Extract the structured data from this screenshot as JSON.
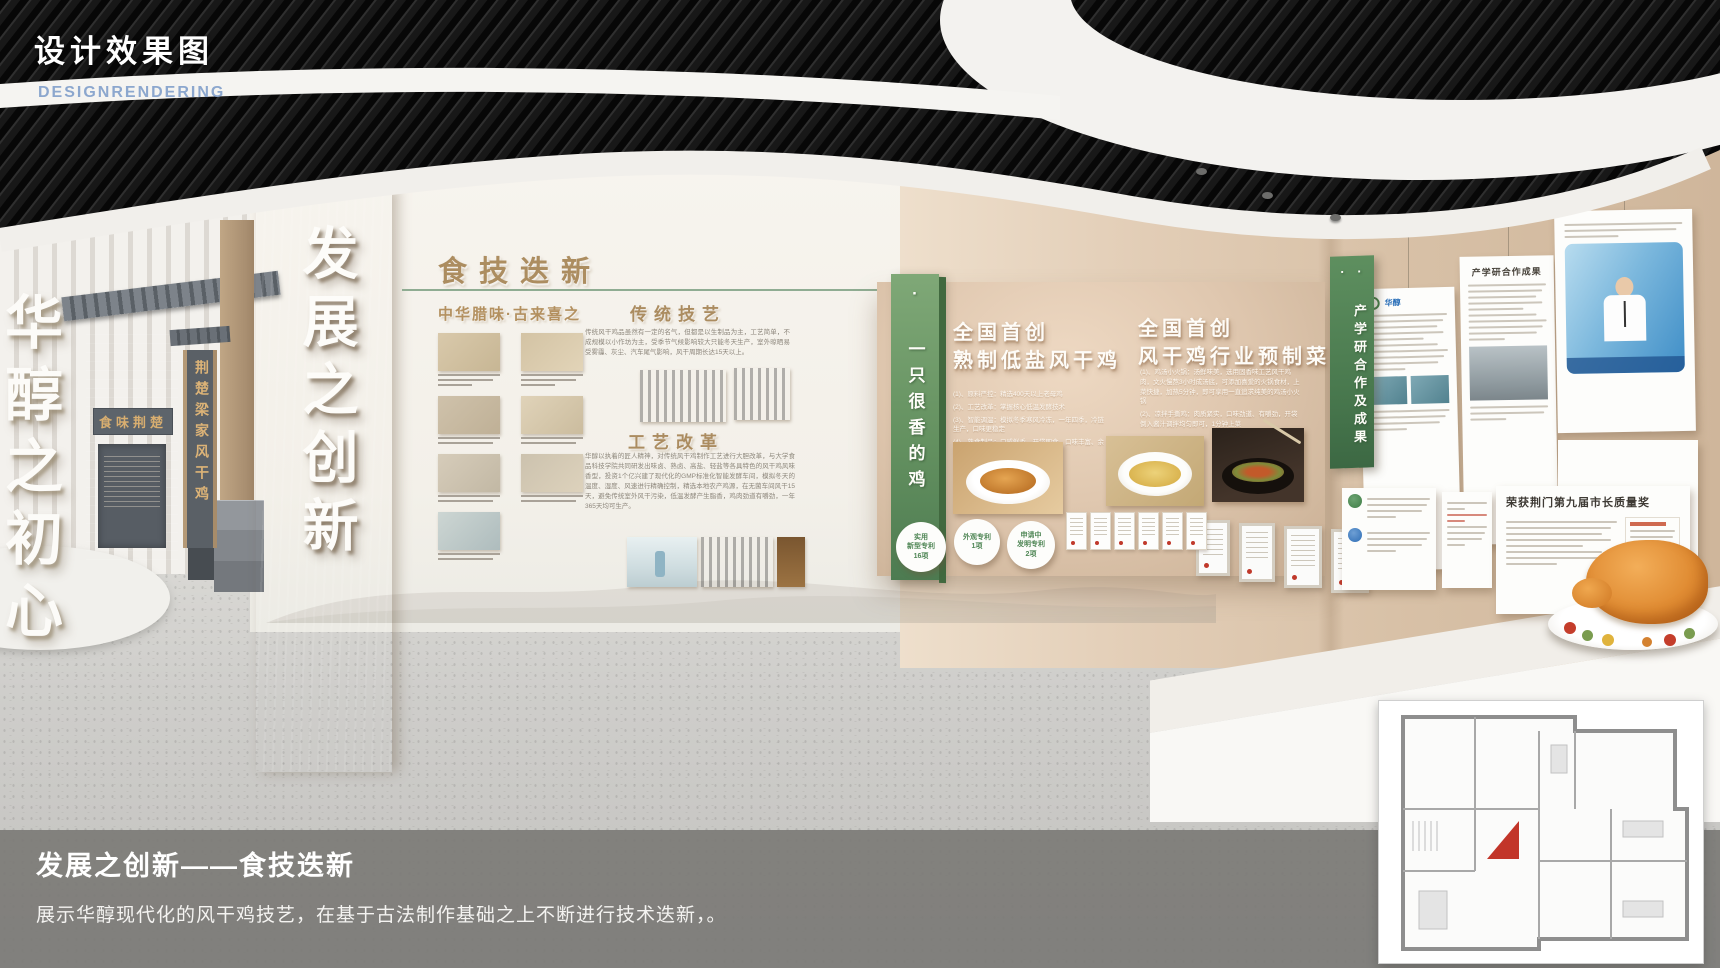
{
  "header": {
    "title": "设计效果图",
    "subtitle": "DESIGNRENDERING"
  },
  "left_wing": {
    "slogan_vertical": "华醇之初心",
    "plaque": "食味荆楚",
    "shop_sign": "荆楚梁家风干鸡"
  },
  "pillar": {
    "text": "发展之创新"
  },
  "tech_wall": {
    "title": "食技迭新",
    "section1": {
      "heading": "中华腊味·古来喜之"
    },
    "section2": {
      "heading": "传统技艺",
      "body": "传统风干鸡品虽然有一定的名气，但都是以生制品为主，工艺简单，不成规模以小作坊为主，受季节气候影响较大只能冬天生产，室外晾晒易受雾霾、灰尘、汽车尾气影响，风干周期长达15天以上。"
    },
    "section3": {
      "heading": "工艺改革",
      "body": "华醇以执着的匠人精神，对传统风干鸡制作工艺进行大胆改革，与大学食品科技学院共同研发出味卤、熟卤、高盐、轻盐等各具特色的风干鸡风味香型，投资1个亿兴建了现代化的GMP标准化智能发酵车间，模拟冬天的温度、湿度、风速进行精确控制，精选本地农产鸡源，在无菌车间风干15天，避免传统室外风干污染，低温发酵产生脂香，鸡肉劲道有嚼劲，一年365天均可生产。"
    }
  },
  "promo": {
    "banner": "· 一只很香的鸡 ·",
    "left": {
      "title_line1": "全国首创",
      "title_line2": "熟制低盐风干鸡",
      "items": [
        "(1)、原料严控：精选400天以上老母鸡",
        "(2)、工艺改革：掌握核心低温发酵技术",
        "(3)、智能调温：模拟冬季寒风冷冻，一年四季，冷链生产，口味更稳定",
        "(4)、熟食制品：口感鲜香、开袋即食、口味丰富、余味绵长"
      ]
    },
    "right": {
      "title_line1": "全国首创",
      "title_line2": "风干鸡行业预制菜",
      "items": [
        "(1)、鸡汤小火锅：汤鲜味美，选用固香味工艺风干鸡肉，文火慢熬3小时成汤底，可添加喜爱的火锅食材，上菜快捷，加热5分钟，即可享用一直追求纯美的鸡汤小火锅",
        "(2)、凉拌手撕鸡：肉质紧实，口味劲道、有嚼劲，开袋倒入酱汁调拌均匀即可，1分钟上菜"
      ]
    },
    "patents": [
      {
        "l1": "实用",
        "l2": "新型专利",
        "l3": "16项"
      },
      {
        "l1": "外观专利",
        "l2": "1项",
        "l3": ""
      },
      {
        "l1": "申请中",
        "l2": "发明专利",
        "l3": "2项"
      }
    ]
  },
  "results_wall": {
    "banner": "· 产学研合作及成果 ·",
    "poster_brand": "华醇",
    "poster_result_title": "产学研合作成果",
    "award_title": "荣获荆门第九届市长质量奖"
  },
  "caption": {
    "title": "发展之创新——食技迭新",
    "body": "展示华醇现代化的风干鸡技艺，在基于古法制作基础之上不断进行技术迭新，。"
  }
}
